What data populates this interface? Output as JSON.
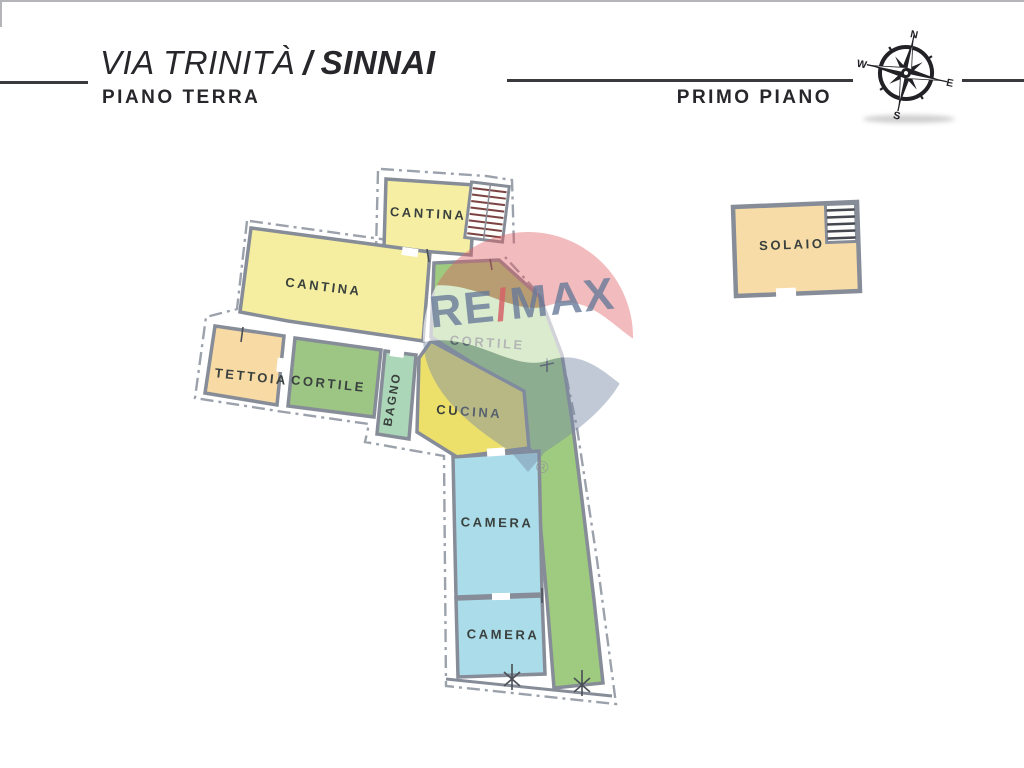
{
  "header": {
    "street": "VIA TRINITÀ",
    "separator": "/",
    "city": "SINNAI",
    "floor_left": "PIANO TERRA",
    "floor_right": "PRIMO PIANO"
  },
  "compass": {
    "north": "N",
    "east": "E",
    "south": "S",
    "west": "W"
  },
  "watermark": {
    "part_re": "RE",
    "part_slash": "/",
    "part_max": "MAX",
    "registered": "®"
  },
  "ground_floor": {
    "rooms": {
      "cantina_top": {
        "label": "CANTINA",
        "color": "#F6EFA3"
      },
      "cantina_main": {
        "label": "CANTINA",
        "color": "#F5EEA0"
      },
      "tettoia": {
        "label": "TETTOIA",
        "color": "#F7DAA4"
      },
      "cortile_small": {
        "label": "CORTILE",
        "color": "#9DC584"
      },
      "bagno": {
        "label": "BAGNO",
        "color": "#ABD6B8"
      },
      "cucina": {
        "label": "CUCINA",
        "color": "#EDE06A"
      },
      "cortile_large": {
        "label": "CORTILE",
        "color": "#9ECB7F"
      },
      "camera_upper": {
        "label": "CAMERA",
        "color": "#ABDCE9"
      },
      "camera_lower": {
        "label": "CAMERA",
        "color": "#ABDCE9"
      }
    }
  },
  "first_floor": {
    "rooms": {
      "solaio": {
        "label": "SOLAIO",
        "color": "#F8DCA8"
      }
    }
  }
}
